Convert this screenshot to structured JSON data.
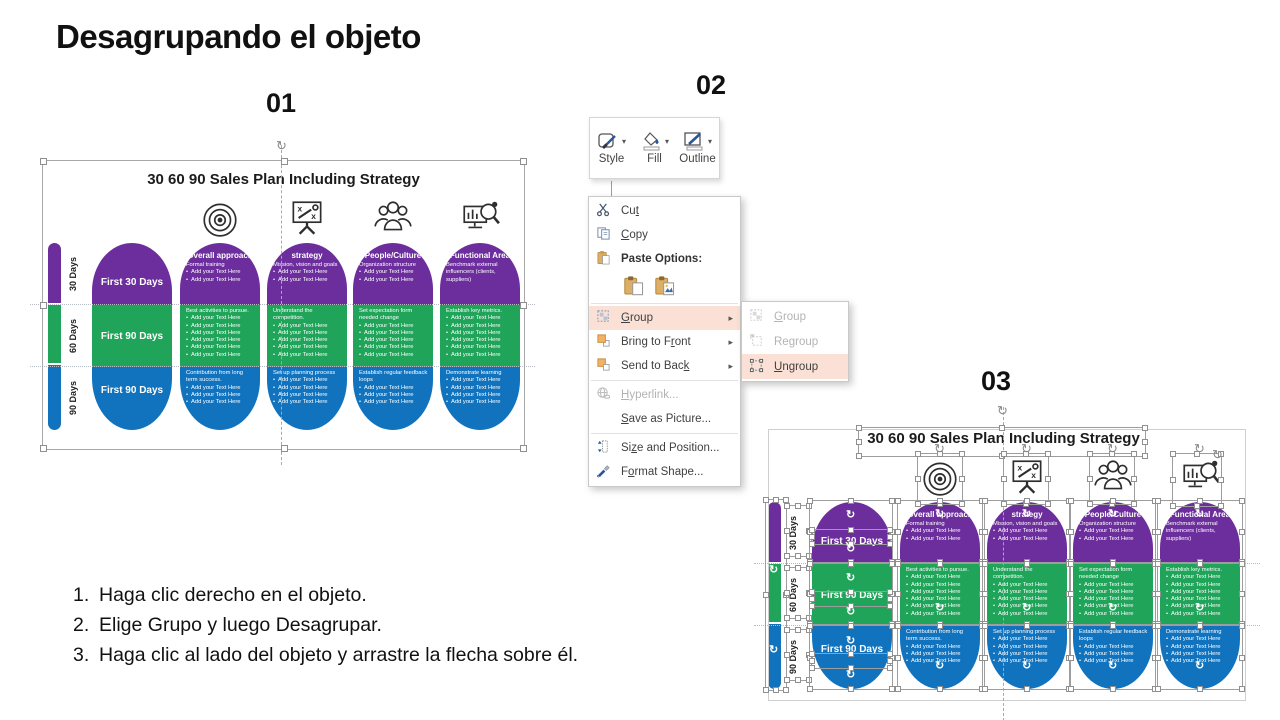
{
  "title": "Desagrupando el objeto",
  "steps": [
    {
      "number": "01"
    },
    {
      "number": "02"
    },
    {
      "number": "03"
    }
  ],
  "instructions": [
    {
      "num": "1.",
      "text": "Haga clic derecho en el objeto."
    },
    {
      "num": "2.",
      "text": "Elige Grupo y luego Desagrupar."
    },
    {
      "num": "3.",
      "text": "Haga clic al lado del objeto y arrastre la flecha sobre él."
    }
  ],
  "mini_toolbar": {
    "style_label": "Style",
    "fill_label": "Fill",
    "outline_label": "Outline"
  },
  "icons": {
    "submenu_arrow": "▸",
    "dropdown_arrow": "▾",
    "rotate": "↻",
    "bullet": "•"
  },
  "context_menu": {
    "cut": {
      "pre": "Cu",
      "key": "t",
      "post": ""
    },
    "copy": {
      "pre": "",
      "key": "C",
      "post": "opy"
    },
    "paste_options_label": "Paste Options:",
    "group": {
      "pre": "",
      "key": "G",
      "post": "roup"
    },
    "bring_to_front": {
      "pre": "Bring to F",
      "key": "r",
      "post": "ont"
    },
    "send_to_back": {
      "pre": "Send to Bac",
      "key": "k",
      "post": ""
    },
    "hyperlink": {
      "pre": "",
      "key": "H",
      "post": "yperlink..."
    },
    "save_as_picture": {
      "pre": "",
      "key": "S",
      "post": "ave as Picture..."
    },
    "size_and_position": {
      "pre": "Si",
      "key": "z",
      "post": "e and Position..."
    },
    "format_shape": {
      "pre": "F",
      "key": "o",
      "post": "rmat Shape..."
    }
  },
  "submenu": {
    "group": {
      "pre": "",
      "key": "G",
      "post": "roup"
    },
    "regroup": {
      "pre": "Re",
      "key": "g",
      "post": "roup"
    },
    "ungroup": {
      "pre": "",
      "key": "U",
      "post": "ngroup"
    }
  },
  "colors": {
    "purple": "#6c2e9c",
    "green": "#1fa45a",
    "blue": "#1173be",
    "menu_highlight": "#fbe0d5"
  },
  "sales_chart": {
    "title": "30 60 90 Sales Plan Including Strategy",
    "rows": [
      {
        "label": "30 Days",
        "first": "First 30 Days"
      },
      {
        "label": "60 Days",
        "first": "First 90 Days"
      },
      {
        "label": "90 Days",
        "first": "First 90 Days"
      }
    ],
    "columns": [
      {
        "header": "Overall approach",
        "icon": "target-icon",
        "cells": [
          {
            "intro": "Formal training",
            "bullets": [
              "Add your Text Here",
              "Add your Text Here"
            ]
          },
          {
            "intro": "Best activities to pursue.",
            "bullets": [
              "Add your Text Here",
              "Add your Text Here",
              "Add your Text Here",
              "Add your Text Here",
              "Add your Text Here",
              "Add your Text Here"
            ]
          },
          {
            "intro": "Contribution from long term success.",
            "bullets": [
              "Add your Text Here",
              "Add your Text Here",
              "Add your Text Here"
            ]
          }
        ]
      },
      {
        "header": "strategy",
        "icon": "strategy-board-icon",
        "cells": [
          {
            "intro": "Mission, vision and goals",
            "bullets": [
              "Add your Text Here",
              "Add your Text Here"
            ]
          },
          {
            "intro": "Understand the competition.",
            "bullets": [
              "Add your Text Here",
              "Add your Text Here",
              "Add your Text Here",
              "Add your Text Here",
              "Add your Text Here"
            ]
          },
          {
            "intro": "Set up planning process",
            "bullets": [
              "Add your Text Here",
              "Add your Text Here",
              "Add your Text Here",
              "Add your Text Here"
            ]
          }
        ]
      },
      {
        "header": "People/Culture",
        "icon": "people-icon",
        "cells": [
          {
            "intro": "Organization structure",
            "bullets": [
              "Add your Text Here",
              "Add your Text Here"
            ]
          },
          {
            "intro": "Set expectation form needed change",
            "bullets": [
              "Add your Text Here",
              "Add your Text Here",
              "Add your Text Here",
              "Add your Text Here",
              "Add your Text Here"
            ]
          },
          {
            "intro": "Establish regular feedback loops",
            "bullets": [
              "Add your Text Here",
              "Add your Text Here",
              "Add your Text Here"
            ]
          }
        ]
      },
      {
        "header": "Functional Area",
        "icon": "analysis-icon",
        "cells": [
          {
            "intro": "Benchmark external influencers (clients, suppliers)",
            "bullets": []
          },
          {
            "intro": "Establish key metrics.",
            "bullets": [
              "Add your Text Here",
              "Add your Text Here",
              "Add your Text Here",
              "Add your Text Here",
              "Add your Text Here",
              "Add your Text Here"
            ]
          },
          {
            "intro": "Demonstrate learning",
            "bullets": [
              "Add your Text Here",
              "Add your Text Here",
              "Add your Text Here",
              "Add your Text Here"
            ]
          }
        ]
      }
    ]
  }
}
